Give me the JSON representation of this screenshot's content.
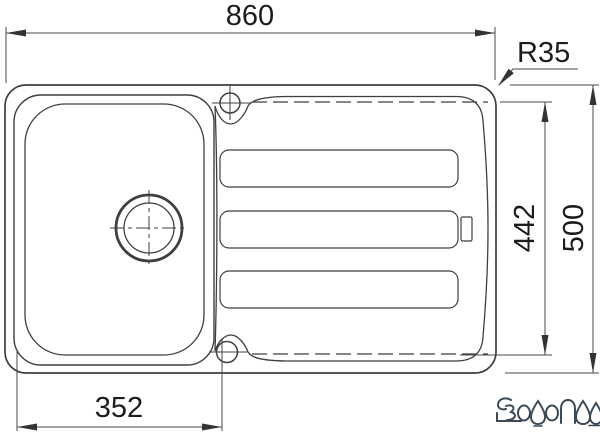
{
  "drawing": {
    "type": "technical dimension drawing",
    "subject": "kitchen inset sink, top view, single bowl with drainboard",
    "background": "#ffffff",
    "line_color": "#3f3f3f",
    "dim_line_color": "#4a4a4a",
    "text_color": "#1c1c1c",
    "dimensions": {
      "overall_width": "860",
      "corner_radius": "R35",
      "inner_depth": "442",
      "overall_depth": "500",
      "bowl_offset": "352"
    },
    "features": {
      "drain_hole": "basket strainer circle with center lines",
      "tap_holes": "two tap holes on center line",
      "drainboard_grooves": 3,
      "overflow_tab": 1
    },
    "watermark": {
      "text": "ВОДОПАД",
      "color": "#3d4a55"
    }
  }
}
